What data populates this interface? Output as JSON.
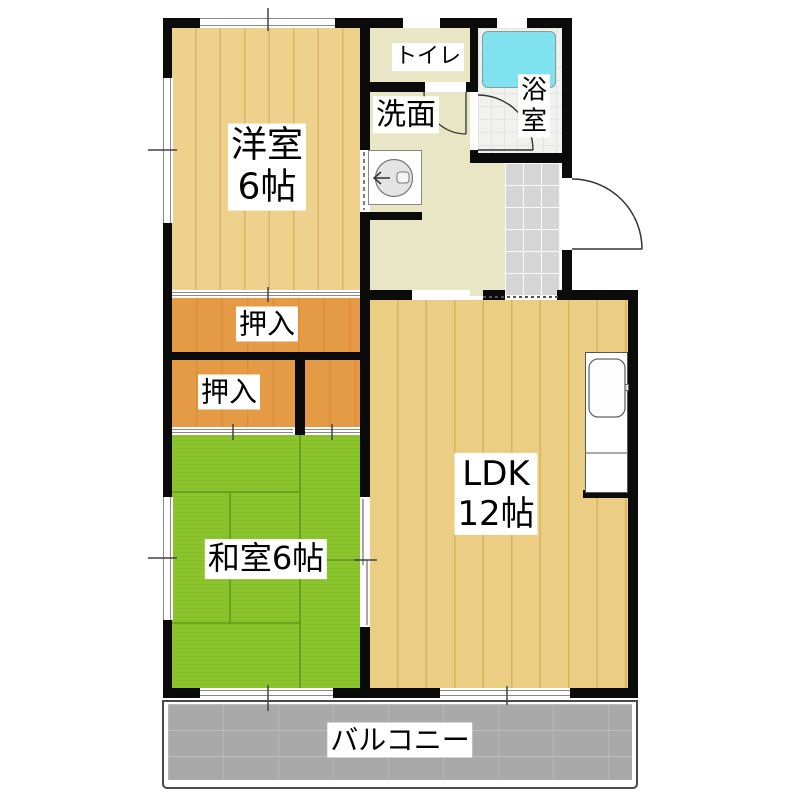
{
  "floorplan": {
    "rooms": {
      "western_room": {
        "line1": "洋室",
        "line2": "6帖"
      },
      "toilet": {
        "name": "トイレ"
      },
      "washroom": {
        "name": "洗面"
      },
      "bathroom": {
        "line1": "浴",
        "line2": "室"
      },
      "closet_upper": {
        "name": "押入"
      },
      "closet_lower": {
        "name": "押入"
      },
      "japanese_room": {
        "name": "和室6帖"
      },
      "ldk": {
        "line1": "LDK",
        "line2": "12帖"
      },
      "balcony": {
        "name": "バルコニー"
      }
    },
    "fixtures": [
      "bathtub",
      "washbasin",
      "kitchen-counter-with-sink",
      "entrance-door",
      "bathroom-door",
      "toilet-door",
      "entry-tile-floor"
    ],
    "colors": {
      "wall": "#0b0b0b",
      "wood_floor": "#edd18c",
      "wood_grain": "#dab662",
      "tatami_green": "#8cc42d",
      "tatami_line": "#5f9a1a",
      "closet_orange": "#e59b45",
      "hall_beige": "#e9e6c5",
      "bathtub_cyan": "#80e2ee",
      "entry_tile_gray": "#d5d5d5",
      "balcony_gray": "#a9a9a9"
    }
  }
}
